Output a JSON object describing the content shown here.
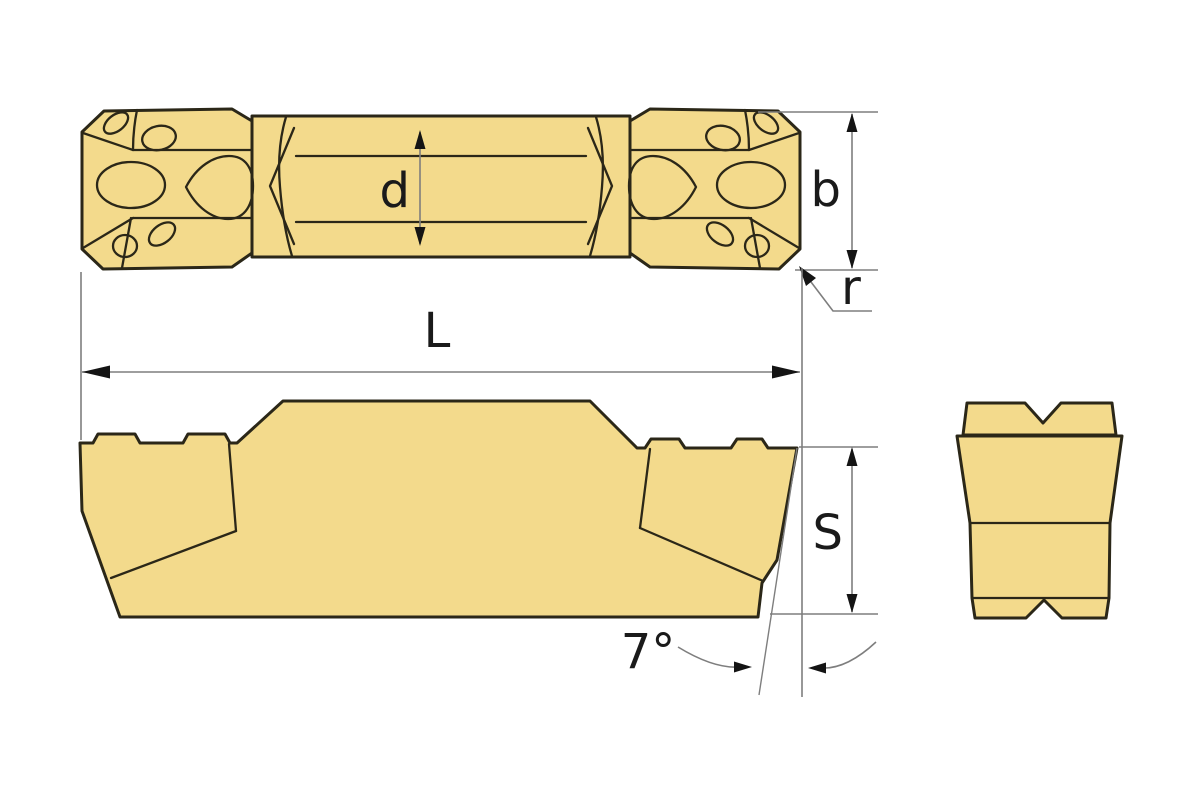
{
  "labels": {
    "d": "d",
    "b": "b",
    "r": "r",
    "length": "L",
    "thickness": "S",
    "angle": "7°"
  },
  "colors": {
    "background": "#FFFFFF",
    "insert_fill": "#F3DA8C",
    "outline_color": "#2B2718",
    "dim_color": "#7E7E7E",
    "arrow_color": "#141414",
    "label_color": "#1A1A1A"
  }
}
